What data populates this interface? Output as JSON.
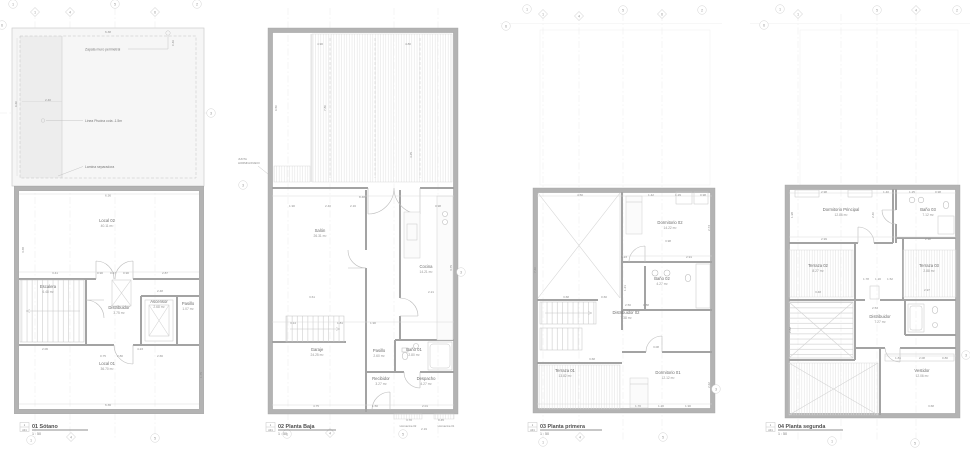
{
  "drawing": {
    "colors": {
      "paper": "#ffffff",
      "wall_gray": "#b3b3b3",
      "partition_gray": "#a3a3a3",
      "hatch_gray": "#dcdcdc",
      "dim_text_gray": "#8f8f8f",
      "label_gray": "#6e6e6e"
    },
    "scale_label": "1 : 50"
  },
  "plans": {
    "sotano": {
      "title": "01 Sótano",
      "scale": "1 : 50",
      "ref_num": "1",
      "ref_sheet": "A01",
      "annotations": [
        {
          "t": "Zapata muro perimetral"
        },
        {
          "t": "Linea Piscina cota -1.5m"
        },
        {
          "t": "Lamina separadora"
        }
      ],
      "rooms": [
        {
          "x": 107,
          "y": 222,
          "name": "Local 02",
          "area": "40.11 m²"
        },
        {
          "x": 48,
          "y": 288,
          "name": "Escalera",
          "area": "6.48 m²"
        },
        {
          "x": 119,
          "y": 309,
          "name": "Distribuidor",
          "area": "3.75 m²"
        },
        {
          "x": 159,
          "y": 303,
          "name": "Ascensor",
          "area": "2.68 m²"
        },
        {
          "x": 188,
          "y": 305,
          "name": "Pasillo",
          "area": "1.07 m²"
        },
        {
          "x": 107,
          "y": 365,
          "name": "Local 01",
          "area": "36.70 m²"
        }
      ],
      "dims": [
        {
          "x": 108,
          "y": 33,
          "v": "6.38"
        },
        {
          "x": 48,
          "y": 101,
          "v": "2.40"
        },
        {
          "x": 17,
          "y": 104,
          "v": "6.60",
          "r": 1
        },
        {
          "x": 174,
          "y": 43,
          "v": "0.46",
          "r": 1
        },
        {
          "x": 108,
          "y": 196.5,
          "v": "6.36"
        },
        {
          "x": 24,
          "y": 250,
          "v": "3.38",
          "r": 1
        },
        {
          "x": 55,
          "y": 274,
          "v": "3.41"
        },
        {
          "x": 100,
          "y": 274,
          "v": "0.90"
        },
        {
          "x": 113,
          "y": 274,
          "v": "0.47"
        },
        {
          "x": 126,
          "y": 274,
          "v": "0.90"
        },
        {
          "x": 165,
          "y": 274,
          "v": "2.87"
        },
        {
          "x": 160,
          "y": 292,
          "v": "2.48"
        },
        {
          "x": 45,
          "y": 350,
          "v": "2.06"
        },
        {
          "x": 140,
          "y": 350,
          "v": "4.23"
        },
        {
          "x": 103,
          "y": 357,
          "v": "0.75"
        },
        {
          "x": 120,
          "y": 357,
          "v": "2.80"
        },
        {
          "x": 160,
          "y": 357,
          "v": "2.66"
        },
        {
          "x": 108,
          "y": 406,
          "v": "6.36"
        },
        {
          "x": 202,
          "y": 375,
          "v": "1.75",
          "r": 1
        }
      ],
      "bubbles": [
        {
          "x": 13,
          "y": 4,
          "n": "1",
          "s": "c"
        },
        {
          "x": 35,
          "y": 12,
          "n": "1",
          "s": "d"
        },
        {
          "x": 70,
          "y": 12,
          "n": "4",
          "s": "d"
        },
        {
          "x": 115,
          "y": 4,
          "n": "5",
          "s": "c"
        },
        {
          "x": 155,
          "y": 12,
          "n": "6",
          "s": "d"
        },
        {
          "x": 197,
          "y": 4,
          "n": "2",
          "s": "c"
        },
        {
          "x": 2,
          "y": 25,
          "n": "6",
          "s": "c"
        },
        {
          "x": 211,
          "y": 113,
          "n": "3",
          "s": "c"
        },
        {
          "x": 31,
          "y": 440,
          "n": "1",
          "s": "c"
        },
        {
          "x": 71,
          "y": 437,
          "n": "4",
          "s": "d"
        },
        {
          "x": 155,
          "y": 438,
          "n": "5",
          "s": "c"
        }
      ]
    },
    "baja": {
      "title": "02 Planta Baja",
      "scale": "1 : 50",
      "ref_num": "1",
      "ref_sheet": "A01",
      "junta_line1": "JUNTA",
      "junta_line2": "HORMIGONADO",
      "hornacina_02": "Hornacina 02",
      "hornacina_01": "Hornacina 01",
      "rooms": [
        {
          "x": 320,
          "y": 232,
          "name": "Salón",
          "area": "26.31 m²"
        },
        {
          "x": 426,
          "y": 268,
          "name": "Cocina",
          "area": "14.21 m²"
        },
        {
          "x": 317,
          "y": 351,
          "name": "Garaje",
          "area": "24.25 m²"
        },
        {
          "x": 379,
          "y": 352,
          "name": "Pasillo",
          "area": "2.60 m²"
        },
        {
          "x": 414,
          "y": 351,
          "name": "Baño 01",
          "area": "2.80 m²"
        },
        {
          "x": 381,
          "y": 380,
          "name": "Recibidor",
          "area": "3.27 m²"
        },
        {
          "x": 426,
          "y": 380,
          "name": "Despacho",
          "area": "4.27 m²"
        }
      ],
      "dims": [
        {
          "x": 320,
          "y": 45,
          "v": "4.90"
        },
        {
          "x": 408,
          "y": 45,
          "v": "4.80"
        },
        {
          "x": 277,
          "y": 108,
          "v": "6.50",
          "r": 1
        },
        {
          "x": 326,
          "y": 108,
          "v": "7.80",
          "r": 1
        },
        {
          "x": 362,
          "y": 198,
          "v": "8.48"
        },
        {
          "x": 292,
          "y": 207,
          "v": "1.90"
        },
        {
          "x": 328,
          "y": 207,
          "v": "2.40"
        },
        {
          "x": 353,
          "y": 207,
          "v": "2.16"
        },
        {
          "x": 438,
          "y": 207,
          "v": "0.98"
        },
        {
          "x": 412,
          "y": 155,
          "v": "4.25",
          "r": 1
        },
        {
          "x": 452,
          "y": 268,
          "v": "3.75",
          "r": 1
        },
        {
          "x": 431,
          "y": 293,
          "v": "2.21"
        },
        {
          "x": 312,
          "y": 298,
          "v": "3.61"
        },
        {
          "x": 293,
          "y": 324,
          "v": "3.14"
        },
        {
          "x": 340,
          "y": 324,
          "v": "1.81"
        },
        {
          "x": 373,
          "y": 324,
          "v": "1.90"
        },
        {
          "x": 316,
          "y": 407,
          "v": "4.75"
        },
        {
          "x": 375,
          "y": 407,
          "v": "1.50"
        },
        {
          "x": 425,
          "y": 407,
          "v": "2.01"
        },
        {
          "x": 409,
          "y": 421,
          "v": "3.70"
        },
        {
          "x": 441,
          "y": 421,
          "v": "0.45"
        },
        {
          "x": 424,
          "y": 430,
          "v": "2.19"
        }
      ],
      "bubbles": [
        {
          "x": 243,
          "y": 185,
          "n": "3",
          "s": "c"
        },
        {
          "x": 461,
          "y": 272,
          "n": "3",
          "s": "c"
        },
        {
          "x": 287,
          "y": 434,
          "n": "1",
          "s": "c"
        },
        {
          "x": 330,
          "y": 433,
          "n": "4",
          "s": "d"
        },
        {
          "x": 403,
          "y": 434,
          "n": "5",
          "s": "c"
        }
      ]
    },
    "primera": {
      "title": "03 Planta primera",
      "scale": "1 : 50",
      "ref_num": "1",
      "ref_sheet": "A01",
      "rooms": [
        {
          "x": 670,
          "y": 224,
          "name": "Dormitorio 02",
          "area": "14.22 m²"
        },
        {
          "x": 662,
          "y": 280,
          "name": "Baño 02",
          "area": "4.27 m²"
        },
        {
          "x": 626,
          "y": 314,
          "name": "Distribuidor 02",
          "area": "7.38 m²"
        },
        {
          "x": 565,
          "y": 372,
          "name": "Terraza 01",
          "area": "13.82 m²"
        },
        {
          "x": 668,
          "y": 374,
          "name": "Dormitorio 01",
          "area": "12.12 m²"
        }
      ],
      "dims": [
        {
          "x": 580,
          "y": 196,
          "v": "4.50"
        },
        {
          "x": 651,
          "y": 196,
          "v": "1.42"
        },
        {
          "x": 678,
          "y": 196,
          "v": "1.29"
        },
        {
          "x": 703,
          "y": 196,
          "v": "0.98"
        },
        {
          "x": 668,
          "y": 242,
          "v": "3.98"
        },
        {
          "x": 624,
          "y": 258,
          "v": "1.23"
        },
        {
          "x": 689,
          "y": 258,
          "v": "2.91"
        },
        {
          "x": 536,
          "y": 270,
          "v": "7.40",
          "r": 1
        },
        {
          "x": 626,
          "y": 288,
          "v": "1.21",
          "r": 1
        },
        {
          "x": 710,
          "y": 228,
          "v": "2.73",
          "r": 1
        },
        {
          "x": 566,
          "y": 298,
          "v": "3.68"
        },
        {
          "x": 604,
          "y": 298,
          "v": "0.60"
        },
        {
          "x": 628,
          "y": 306,
          "v": "2.50"
        },
        {
          "x": 646,
          "y": 306,
          "v": "0.88"
        },
        {
          "x": 592,
          "y": 360,
          "v": "3.68"
        },
        {
          "x": 656,
          "y": 348,
          "v": "3.08"
        },
        {
          "x": 638,
          "y": 407,
          "v": "1.70"
        },
        {
          "x": 661,
          "y": 407,
          "v": "1.20"
        },
        {
          "x": 688,
          "y": 407,
          "v": "1.90"
        },
        {
          "x": 710,
          "y": 385,
          "v": "2.62",
          "r": 1
        }
      ],
      "bubbles": [
        {
          "x": 506,
          "y": 26,
          "n": "6",
          "s": "c"
        },
        {
          "x": 527,
          "y": 9,
          "n": "1",
          "s": "c"
        },
        {
          "x": 543,
          "y": 14,
          "n": "1",
          "s": "d"
        },
        {
          "x": 579,
          "y": 16,
          "n": "4",
          "s": "d"
        },
        {
          "x": 623,
          "y": 10,
          "n": "5",
          "s": "c"
        },
        {
          "x": 662,
          "y": 14,
          "n": "6",
          "s": "d"
        },
        {
          "x": 702,
          "y": 10,
          "n": "2",
          "s": "c"
        },
        {
          "x": 716,
          "y": 389,
          "n": "3",
          "s": "c"
        },
        {
          "x": 543,
          "y": 442,
          "n": "1",
          "s": "c"
        },
        {
          "x": 580,
          "y": 437,
          "n": "4",
          "s": "d"
        },
        {
          "x": 663,
          "y": 437,
          "n": "5",
          "s": "c"
        }
      ]
    },
    "segunda": {
      "title": "04 Planta segunda",
      "scale": "1 : 50",
      "ref_num": "1",
      "ref_sheet": "A01",
      "rooms": [
        {
          "x": 841,
          "y": 211,
          "name": "Dormitorio Principal",
          "area": "12.86 m²"
        },
        {
          "x": 928,
          "y": 211,
          "name": "Baño 03",
          "area": "7.12 m²"
        },
        {
          "x": 818,
          "y": 267,
          "name": "Terraza 02",
          "area": "8.27 m²"
        },
        {
          "x": 929,
          "y": 267,
          "name": "Terraza 03",
          "area": "2.88 m²"
        },
        {
          "x": 880,
          "y": 318,
          "name": "Distribuidor",
          "area": "7.27 m²"
        },
        {
          "x": 922,
          "y": 372,
          "name": "Vestidor",
          "area": "12.06 m²"
        }
      ],
      "dims": [
        {
          "x": 824,
          "y": 193,
          "v": "2.98"
        },
        {
          "x": 886,
          "y": 193,
          "v": "1.40"
        },
        {
          "x": 912,
          "y": 193,
          "v": "1.25"
        },
        {
          "x": 938,
          "y": 193,
          "v": "0.98"
        },
        {
          "x": 793,
          "y": 215,
          "v": "1.98",
          "r": 1
        },
        {
          "x": 874,
          "y": 215,
          "v": "2.40",
          "r": 1
        },
        {
          "x": 824,
          "y": 240,
          "v": "2.99"
        },
        {
          "x": 928,
          "y": 240,
          "v": "2.98"
        },
        {
          "x": 866,
          "y": 280,
          "v": "1.78"
        },
        {
          "x": 878,
          "y": 280,
          "v": "1.20"
        },
        {
          "x": 890,
          "y": 280,
          "v": "1.52"
        },
        {
          "x": 818,
          "y": 293,
          "v": "3.48"
        },
        {
          "x": 927,
          "y": 291,
          "v": "2.97"
        },
        {
          "x": 875,
          "y": 309,
          "v": "2.53"
        },
        {
          "x": 898,
          "y": 359,
          "v": "1.81"
        },
        {
          "x": 922,
          "y": 359,
          "v": "2.08"
        },
        {
          "x": 945,
          "y": 359,
          "v": "0.80"
        },
        {
          "x": 931,
          "y": 407,
          "v": "3.68"
        },
        {
          "x": 791,
          "y": 330,
          "v": "2.82",
          "r": 1
        }
      ],
      "bubbles": [
        {
          "x": 764,
          "y": 25,
          "n": "6",
          "s": "c"
        },
        {
          "x": 780,
          "y": 9,
          "n": "1",
          "s": "c"
        },
        {
          "x": 798,
          "y": 14,
          "n": "1",
          "s": "d"
        },
        {
          "x": 877,
          "y": 10,
          "n": "5",
          "s": "c"
        },
        {
          "x": 916,
          "y": 10,
          "n": "4",
          "s": "d"
        },
        {
          "x": 957,
          "y": 10,
          "n": "2",
          "s": "c"
        },
        {
          "x": 832,
          "y": 441,
          "n": "1",
          "s": "c"
        },
        {
          "x": 915,
          "y": 443,
          "n": "5",
          "s": "c"
        },
        {
          "x": 966,
          "y": 355,
          "n": "3",
          "s": "c"
        }
      ]
    }
  }
}
